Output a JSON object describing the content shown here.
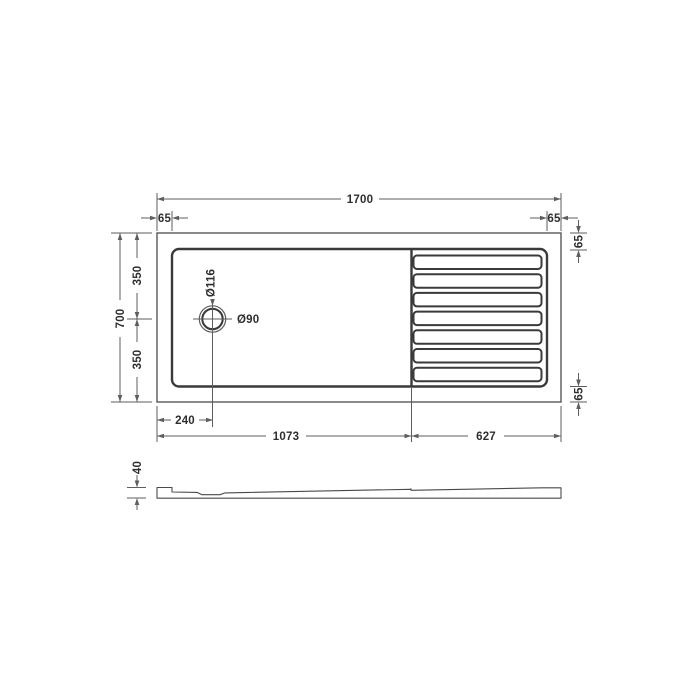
{
  "drawing": {
    "plan": {
      "overall_width": "1700",
      "inset_top_left": "65",
      "inset_top_right": "65",
      "inset_right_top": "65",
      "inset_right_bottom": "65",
      "overall_depth": "700",
      "depth_upper": "350",
      "depth_lower": "350",
      "drain_offset": "240",
      "flat_section": "1073",
      "ribbed_section": "627",
      "drain_outer_dia": "Ø116",
      "drain_waste_dia": "Ø90",
      "rib_count": 7
    },
    "side": {
      "height": "40"
    },
    "colors": {
      "outline": "#4a4a4a",
      "heavy_line": "#3a3a3a",
      "dim_line": "#5e5e5e",
      "text": "#2e2e2e",
      "background": "#ffffff"
    }
  }
}
